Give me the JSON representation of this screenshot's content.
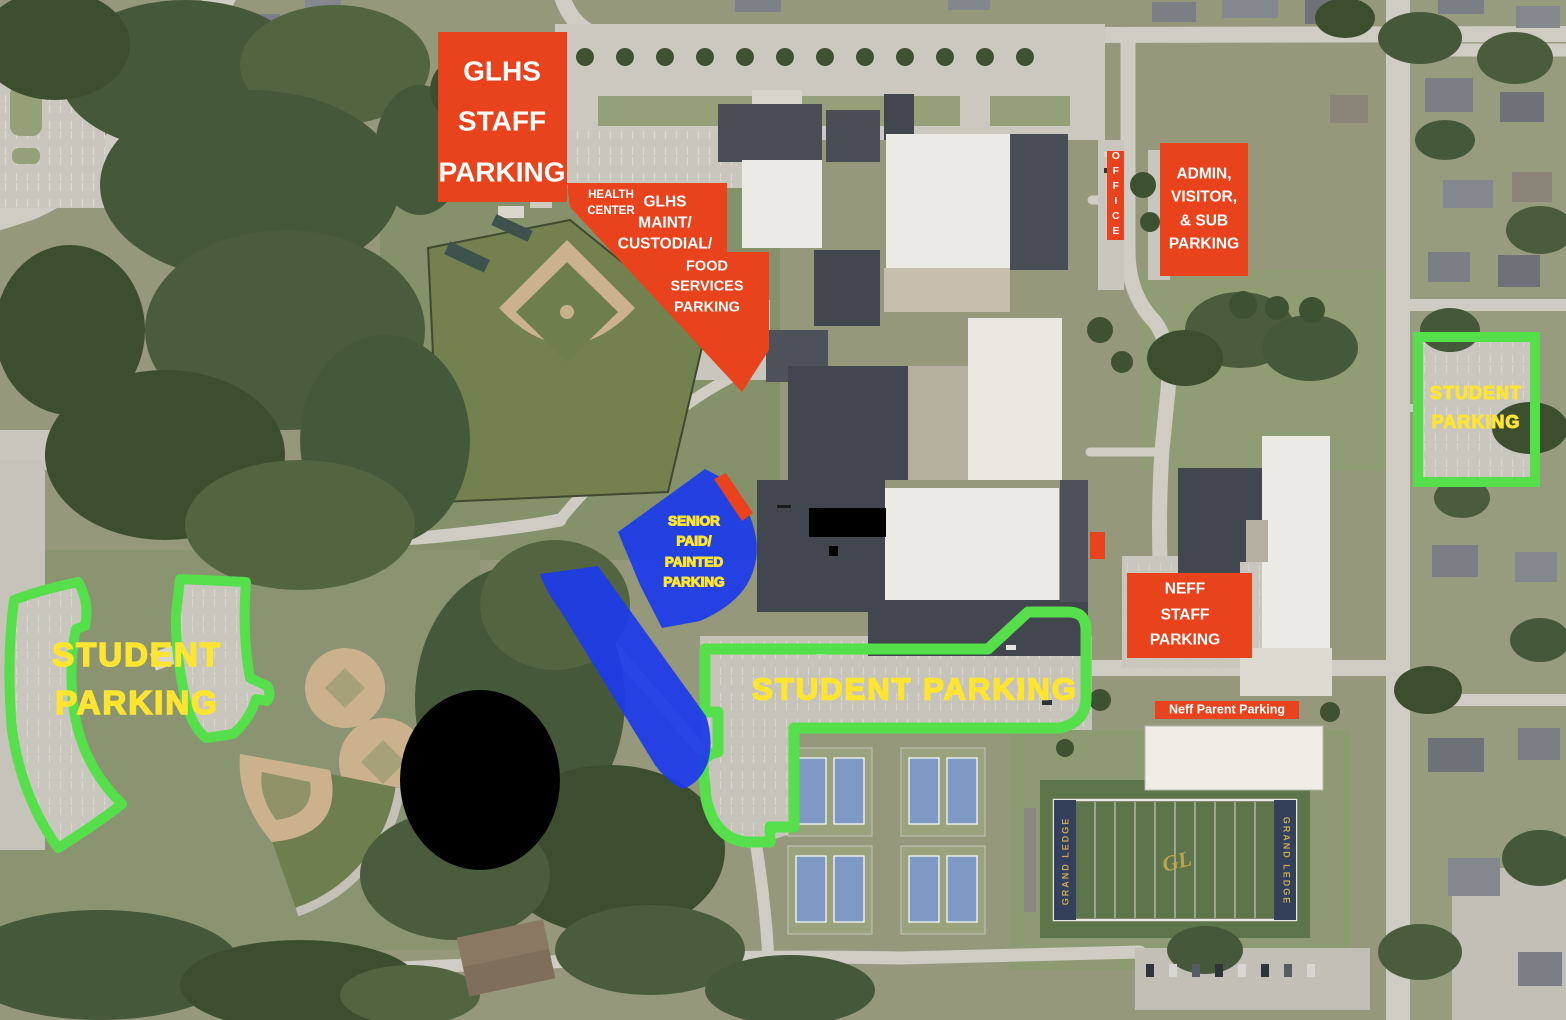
{
  "title": "GLHS campus parking map",
  "colors": {
    "overlay_red": "#E8431C",
    "overlay_green": "#55DF4A",
    "overlay_blue": "#1C3AEB",
    "label_yellow": "#FFE430",
    "label_white": "#FFFFFF",
    "endzone_navy": "#32405C",
    "endzone_gold": "#C8A750",
    "field_green": "#5E744B",
    "redaction_black": "#000000"
  },
  "labels": {
    "glhs_staff": [
      "GLHS",
      "STAFF",
      "PARKING"
    ],
    "health_center": [
      "HEALTH",
      "CENTER"
    ],
    "maint": [
      "GLHS",
      "MAINT/",
      "CUSTODIAL/"
    ],
    "food": [
      "FOOD",
      "SERVICES",
      "PARKING"
    ],
    "office": "OFFICE",
    "admin": [
      "ADMIN,",
      "VISITOR,",
      "& SUB",
      "PARKING"
    ],
    "student_right": [
      "STUDENT",
      "PARKING"
    ],
    "senior": [
      "SENIOR",
      "PAID/",
      "PAINTED",
      "PARKING"
    ],
    "neff_staff": [
      "NEFF",
      "STAFF",
      "PARKING"
    ],
    "neff_parent": "Neff Parent Parking",
    "student_center": "STUDENT PARKING",
    "student_left": [
      "STUDENT",
      "PARKING"
    ],
    "football": {
      "endzone": "GRAND LEDGE",
      "logo": "GL"
    }
  }
}
